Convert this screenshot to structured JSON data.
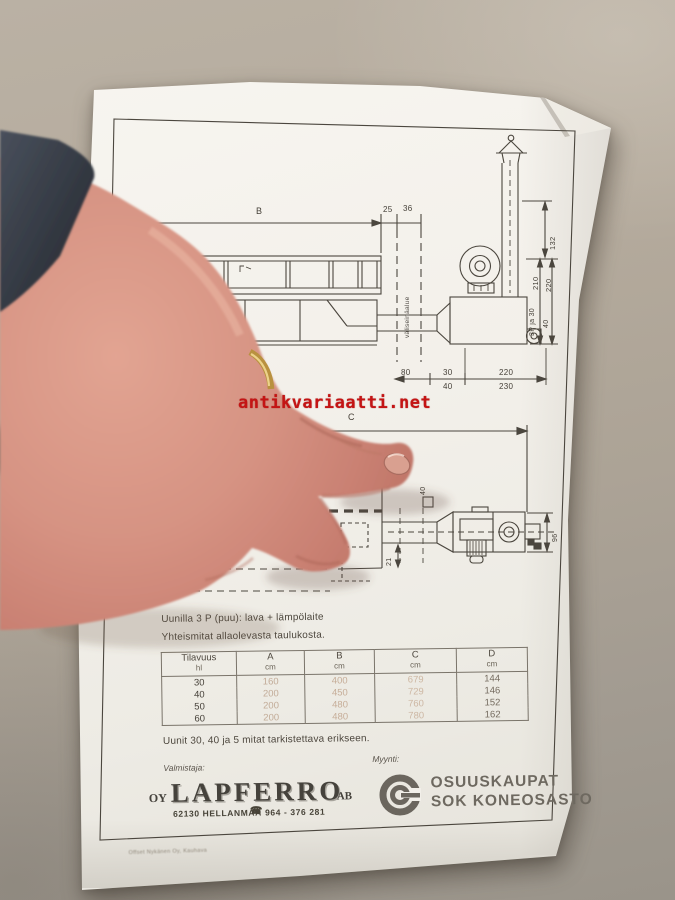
{
  "photo": {
    "watermark": "antikvariaatti.net",
    "watermark_color": "#c41414"
  },
  "side_view": {
    "dim_b": "B",
    "dim_25": "25",
    "dim_36": "36",
    "dim_132": "132",
    "dim_210": "210",
    "dim_220_height": "220",
    "models_210": "3P ja 30",
    "models_220": "40",
    "partition": "väliseinäalue",
    "dim_80": "80",
    "dim_len_30": "30",
    "dim_len_40": "40",
    "dim_len_220": "220",
    "dim_len_230": "230"
  },
  "plan_view": {
    "dim_c": "C",
    "dim_40": "40",
    "dim_96": "96",
    "dim_21": "21"
  },
  "notes": {
    "line1": "Uunilla 3 P (puu): lava + lämpölaite",
    "line2": "Yhteismitat allaolevasta taulukosta.",
    "line3": "Uunit 30, 40 ja 5 mitat tarkistettava erikseen."
  },
  "table": {
    "headers": [
      {
        "t": "Tilavuus",
        "u": "hl"
      },
      {
        "t": "A",
        "u": "cm"
      },
      {
        "t": "B",
        "u": "cm"
      },
      {
        "t": "C",
        "u": "cm"
      },
      {
        "t": "D",
        "u": "cm"
      }
    ],
    "rows": [
      [
        "30",
        "160",
        "400",
        "679",
        "144"
      ],
      [
        "40",
        "200",
        "450",
        "729",
        "146"
      ],
      [
        "50",
        "200",
        "480",
        "760",
        "152"
      ],
      [
        "60",
        "200",
        "480",
        "780",
        "162"
      ]
    ]
  },
  "footer": {
    "manufacturer_label": "Valmistaja:",
    "seller_label": "Myynti:",
    "brand_prefix": "OY",
    "brand_name": "LAPFERRO",
    "brand_suffix": "AB",
    "brand_address": "62130  HELLANMAA",
    "phone_icon": "☎",
    "brand_phone": "964 - 376 281",
    "seller_name_line1": "OSUUSKAUPAT",
    "seller_name_line2": "SOK KONEOSASTO",
    "printer_line": "Offset Nykänen Oy, Kauhava"
  }
}
